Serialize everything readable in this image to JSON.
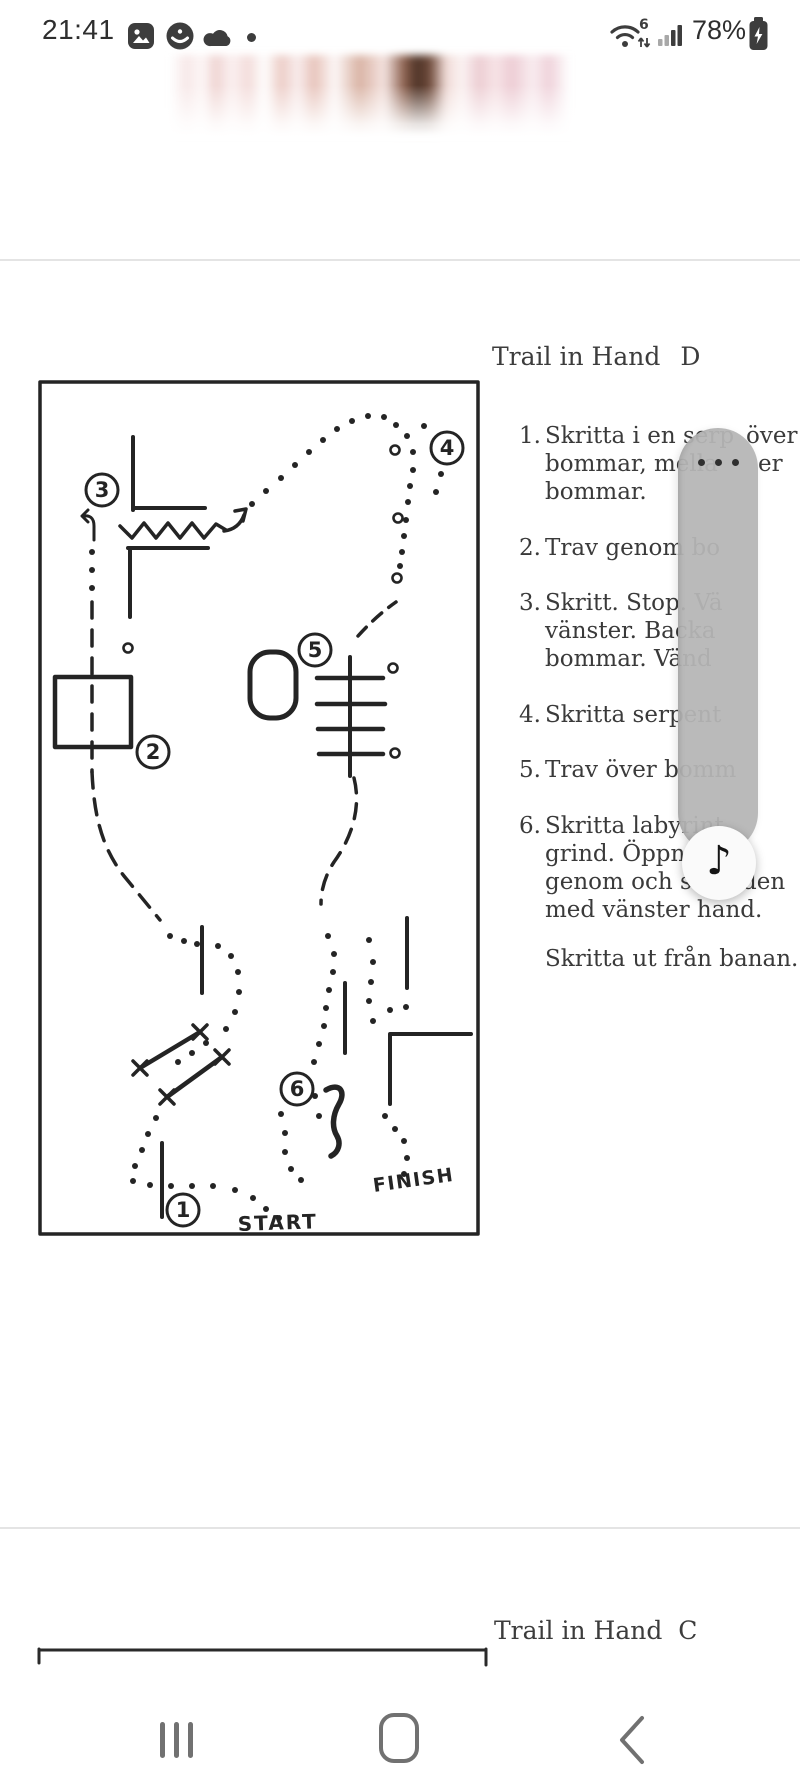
{
  "status_bar": {
    "time": "21:41",
    "battery_percent": "78%",
    "wifi_generation": "6"
  },
  "page1": {
    "heading": "Trail in Hand",
    "heading_variant": "D",
    "map": {
      "start_label": "START",
      "finish_label": "FINISH",
      "obstacles": [
        "1",
        "2",
        "3",
        "4",
        "5",
        "6"
      ]
    },
    "instructions": [
      {
        "num": "1.",
        "lines": [
          "Skritta i en serp",
          "bommar, mella",
          "bommar."
        ],
        "fragments": {
          "0": "över",
          "1": "er"
        }
      },
      {
        "num": "2.",
        "lines": [
          "Trav genom bo"
        ],
        "fragments": {}
      },
      {
        "num": "3.",
        "lines": [
          "Skritt. Stop. Vä",
          "vänster. Backa",
          "bommar. Vänd"
        ],
        "fragments": {}
      },
      {
        "num": "4.",
        "lines": [
          "Skritta serpent"
        ],
        "fragments": {}
      },
      {
        "num": "5.",
        "lines": [
          "Trav över bomm"
        ],
        "fragments": {}
      },
      {
        "num": "6.",
        "lines": [
          "Skritta labyrint",
          "grind. Öppna, p",
          "genom och stäng",
          "med vänster hand."
        ],
        "fragments": {
          "2": "den"
        }
      }
    ],
    "outro": "Skritta ut från banan."
  },
  "page2": {
    "heading": "Trail in Hand",
    "heading_variant": "C"
  },
  "overlay": {
    "menu_icon": "more-options-dots",
    "music_icon": "♪"
  }
}
